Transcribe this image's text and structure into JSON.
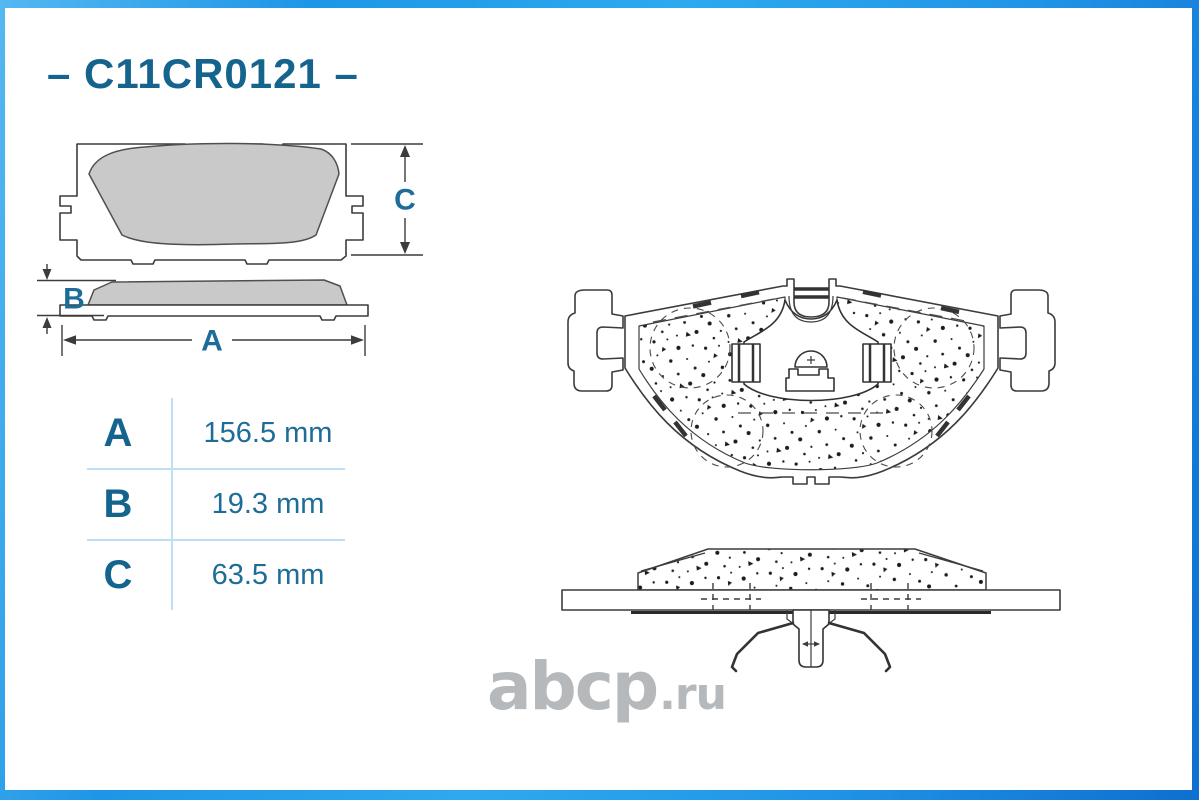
{
  "product": {
    "part_number": "C11CR0121",
    "header_display": "– C11CR0121 –"
  },
  "dimension_table": {
    "rows": [
      {
        "label": "A",
        "value": "156.5 mm"
      },
      {
        "label": "B",
        "value": "19.3 mm"
      },
      {
        "label": "C",
        "value": "63.5 mm"
      }
    ]
  },
  "diagram_labels": {
    "a": "A",
    "b": "B",
    "c": "C"
  },
  "watermark": {
    "main": "abcp",
    "suffix": ".ru"
  },
  "colors": {
    "accent-blue": "#1e9ae8",
    "text-teal": "#15648e",
    "value-teal": "#1d6d98",
    "table-line": "#bfe0f4",
    "stroke-dark": "#3c3c3c",
    "pad-gray": "#c9c9c9",
    "watermark-gray": "#b5b9bc"
  }
}
